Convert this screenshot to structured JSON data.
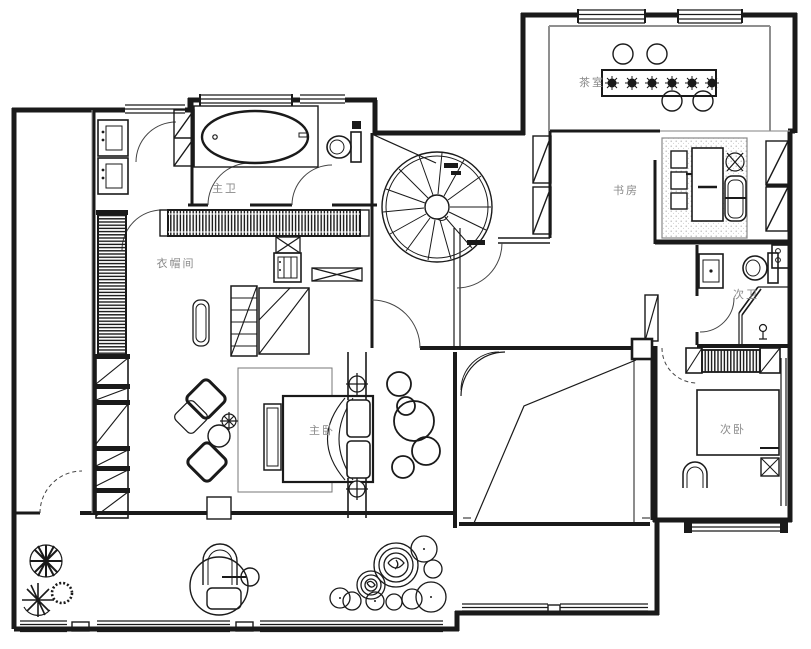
{
  "title": "residential floor plan",
  "colors": {
    "wall": "#1a1a1a",
    "label": "#8a8a8a",
    "background": "#ffffff"
  },
  "rooms": [
    {
      "id": "master-bath",
      "label": "主卫",
      "features": [
        "bathtub",
        "toilet",
        "shower-room",
        "double-vanity",
        "doors"
      ]
    },
    {
      "id": "cloakroom",
      "label": "衣帽间",
      "features": [
        "wardrobe-run",
        "shelving-column",
        "island-cabinets",
        "appliance-cabinet"
      ]
    },
    {
      "id": "master-bedroom",
      "label": "主卧",
      "features": [
        "double-bed",
        "bed-bench",
        "armchairs",
        "round-side-table",
        "rug"
      ]
    },
    {
      "id": "tea-room",
      "label": "茶室",
      "features": [
        "long-tea-table",
        "six-seat-markers",
        "four-stools",
        "windows"
      ]
    },
    {
      "id": "study",
      "label": "书房",
      "features": [
        "desk",
        "desk-chair",
        "three-stools",
        "plant",
        "dotted-rug",
        "window-wall"
      ]
    },
    {
      "id": "second-bath",
      "label": "次卫",
      "features": [
        "toilet",
        "basin",
        "shower-corner",
        "floor-drain",
        "washer"
      ]
    },
    {
      "id": "second-bedroom",
      "label": "次卧",
      "features": [
        "double-bed",
        "hatched-wardrobe",
        "nightstand",
        "chair",
        "window-strip"
      ]
    },
    {
      "id": "staircase",
      "features": [
        "spiral-staircase"
      ]
    },
    {
      "id": "terrace",
      "features": [
        "fan-plant",
        "spoke-plant",
        "spiky-shrub",
        "lounge-chair",
        "side-table",
        "stool",
        "plant-cluster",
        "window-band"
      ]
    },
    {
      "id": "void-space",
      "features": [
        "sloped-ceiling-lines",
        "curved-glass-corner",
        "column"
      ]
    },
    {
      "id": "hall",
      "features": [
        "circle-decor-cluster",
        "door-arcs"
      ]
    }
  ]
}
